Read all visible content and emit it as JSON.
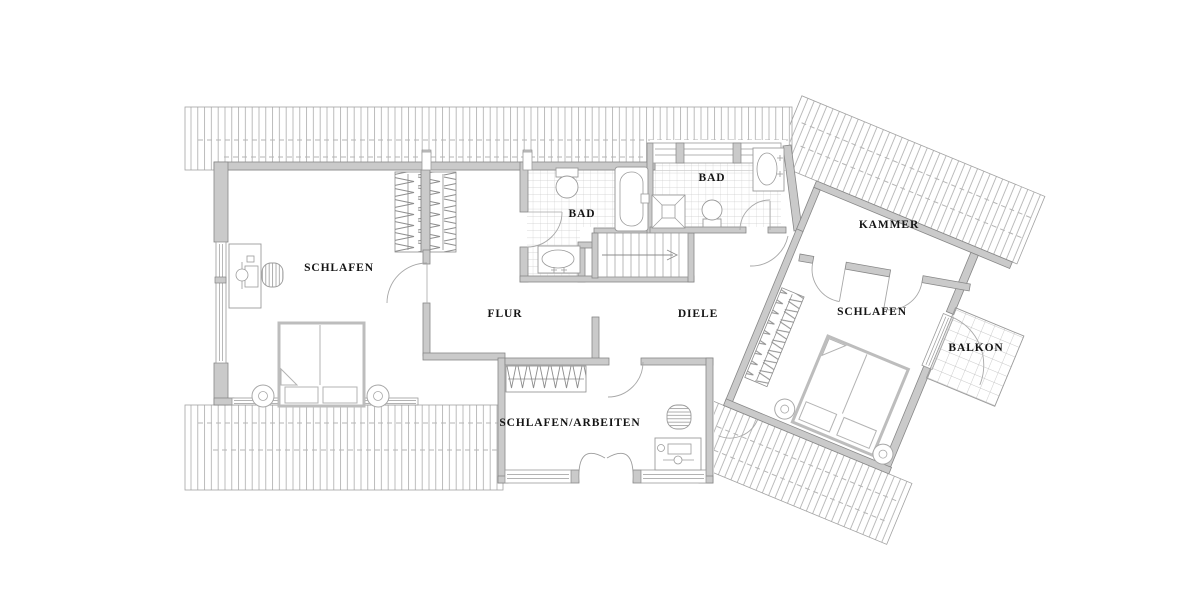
{
  "plan": {
    "type": "floor-plan",
    "floor": "Dachgeschoss",
    "rooms": {
      "schlafen_left": "SCHLAFEN",
      "bad_left": "BAD",
      "bad_right": "BAD",
      "flur": "FLUR",
      "diele": "DIELE",
      "kammer": "KAMMER",
      "schlafen_right": "SCHLAFEN",
      "balkon": "BALKON",
      "schlafen_arbeiten": "SCHLAFEN/ARBEITEN"
    },
    "colors": {
      "background": "#ffffff",
      "wall_fill": "#cacaca",
      "wall_stroke": "#878787",
      "roof_hatch": "#ababab",
      "tile_line": "#cccccc",
      "dashed_line": "#b5b5b5",
      "fixture_stroke": "#9b9b9b",
      "label_text": "#141414"
    }
  }
}
